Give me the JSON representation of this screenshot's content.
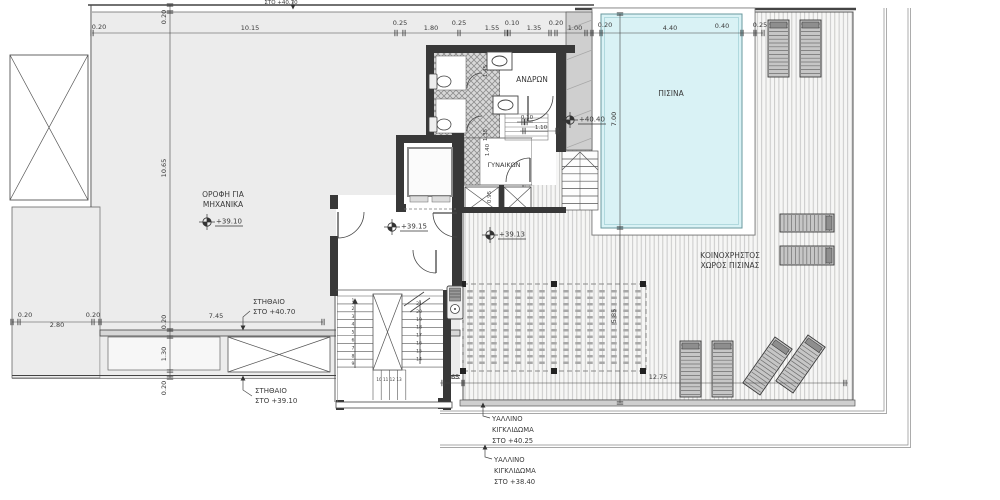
{
  "title": "Roof / pool deck floor plan (+39.10 – +40.40)",
  "colors": {
    "slab": "#ececec",
    "wall_dark": "#383838",
    "wall_band": "#cfcfcf",
    "deck_bg": "#f6f6f5",
    "deck_stripe": "#c4c4c4",
    "pool_fill": "#d9f2f5",
    "pool_edge": "#69989e",
    "text": "#3a3a3a"
  },
  "rooms": [
    {
      "name": "ΟΡΟΦΗ ΓΙΑ ΜΗΧΑΝΙΚΑ",
      "level": "+39.10"
    },
    {
      "name": "ΑΝΔΡΩΝ"
    },
    {
      "name": "ΓΥΝΑΙΚΩΝ"
    },
    {
      "name": "ΠΙΣΙΝΑ",
      "level": "+40.40"
    },
    {
      "name": "ΚΟΙΝΟΧΡΗΣΤΟΣ ΧΩΡΟΣ ΠΙΣΙΝΑΣ",
      "level": "+39.13"
    }
  ],
  "levels": [
    {
      "x": 207,
      "y": 222,
      "label": "+39.10"
    },
    {
      "x": 392,
      "y": 227,
      "label": "+39.15"
    },
    {
      "x": 490,
      "y": 235,
      "label": "+39.13"
    },
    {
      "x": 570,
      "y": 120,
      "label": "+40.40"
    }
  ],
  "stair": {
    "left": [
      "1",
      "2",
      "3",
      "4",
      "5",
      "6",
      "7",
      "8",
      "9"
    ],
    "right": [
      "21",
      "20",
      "19",
      "18",
      "17",
      "16",
      "15",
      "14"
    ],
    "bottom": "10 11 12 13"
  },
  "labels": [
    {
      "t": "0.20",
      "x": 99,
      "y": 29,
      "s": 6.5
    },
    {
      "t": "10.15",
      "x": 250,
      "y": 30,
      "s": 6.5
    },
    {
      "t": "0.25",
      "x": 400,
      "y": 25,
      "s": 6.5
    },
    {
      "t": "1.80",
      "x": 431,
      "y": 30,
      "s": 6.5
    },
    {
      "t": "0.25",
      "x": 459,
      "y": 25,
      "s": 6.5
    },
    {
      "t": "1.55",
      "x": 492,
      "y": 30,
      "s": 6.5
    },
    {
      "t": "0.10",
      "x": 512,
      "y": 25,
      "s": 6.5
    },
    {
      "t": "1.35",
      "x": 534,
      "y": 30,
      "s": 6.5
    },
    {
      "t": "0.20",
      "x": 556,
      "y": 25,
      "s": 6.5
    },
    {
      "t": "1.00",
      "x": 575,
      "y": 30,
      "s": 6.5
    },
    {
      "t": "0.20",
      "x": 605,
      "y": 27,
      "s": 6.5
    },
    {
      "t": "4.40",
      "x": 670,
      "y": 30,
      "s": 6.5
    },
    {
      "t": "0.40",
      "x": 722,
      "y": 28,
      "s": 6.5
    },
    {
      "t": "0.25",
      "x": 760,
      "y": 27,
      "s": 6.5
    },
    {
      "t": "0.20",
      "x": 166,
      "y": 17,
      "s": 6.5,
      "r": -90
    },
    {
      "t": "10.65",
      "x": 166,
      "y": 168,
      "s": 6.5,
      "r": -90
    },
    {
      "t": "0.20",
      "x": 166,
      "y": 322,
      "s": 6.5,
      "r": -90
    },
    {
      "t": "1.30",
      "x": 166,
      "y": 354,
      "s": 6.5,
      "r": -90
    },
    {
      "t": "0.20",
      "x": 166,
      "y": 388,
      "s": 6.5,
      "r": -90
    },
    {
      "t": "0.20",
      "x": 25,
      "y": 317,
      "s": 6.5
    },
    {
      "t": "2.80",
      "x": 57,
      "y": 327,
      "s": 6.5
    },
    {
      "t": "0.20",
      "x": 93,
      "y": 317,
      "s": 6.5
    },
    {
      "t": "7.45",
      "x": 216,
      "y": 318,
      "s": 6.5
    },
    {
      "t": "ΣΤΗΘΑΙΟ",
      "x": 253,
      "y": 304,
      "s": 7,
      "a": "s"
    },
    {
      "t": "ΣΤΟ +40.70",
      "x": 253,
      "y": 314,
      "s": 7,
      "a": "s"
    },
    {
      "t": "ΣΤΗΘΑΙΟ",
      "x": 255,
      "y": 393,
      "s": 7,
      "a": "s"
    },
    {
      "t": "ΣΤΟ +39.10",
      "x": 255,
      "y": 403,
      "s": 7,
      "a": "s"
    },
    {
      "t": "ΟΡΟΦΗ ΓΙΑ",
      "x": 223,
      "y": 197,
      "s": 7.5
    },
    {
      "t": "ΜΗΧΑΝΙΚΑ",
      "x": 223,
      "y": 207,
      "s": 7.5
    },
    {
      "t": "ΑΝΔΡΩΝ",
      "x": 532,
      "y": 82,
      "s": 7.5
    },
    {
      "t": "ΓΥΝΑΙΚΩΝ",
      "x": 504,
      "y": 167,
      "s": 6.5
    },
    {
      "t": "ΠΙΣΙΝΑ",
      "x": 671,
      "y": 96,
      "s": 7.5
    },
    {
      "t": "ΚΟΙΝΟΧΡΗΣΤΟΣ",
      "x": 730,
      "y": 258,
      "s": 7.5
    },
    {
      "t": "ΧΩΡΟΣ ΠΙΣΙΝΑΣ",
      "x": 730,
      "y": 268,
      "s": 7.5
    },
    {
      "t": "0.10",
      "x": 527,
      "y": 119,
      "s": 5.5
    },
    {
      "t": "1.10",
      "x": 541,
      "y": 129,
      "s": 5.5
    },
    {
      "t": "1.45",
      "x": 487,
      "y": 71,
      "s": 5.5,
      "r": -90
    },
    {
      "t": "1.35",
      "x": 487,
      "y": 135,
      "s": 5.5,
      "r": -90
    },
    {
      "t": "1.40",
      "x": 489,
      "y": 150,
      "s": 5.5,
      "r": -90
    },
    {
      "t": "0.95",
      "x": 491,
      "y": 197,
      "s": 5.5,
      "r": -90
    },
    {
      "t": "7.00",
      "x": 616,
      "y": 119,
      "s": 6.5,
      "r": -90
    },
    {
      "t": "5.85",
      "x": 616,
      "y": 316,
      "s": 6.5,
      "r": -90
    },
    {
      "t": "12.75",
      "x": 658,
      "y": 379,
      "s": 6.5
    },
    {
      "t": "0.65",
      "x": 452,
      "y": 379,
      "s": 6.5
    },
    {
      "t": "ΥΑΛΛΙΝΟ",
      "x": 492,
      "y": 421,
      "s": 6.8,
      "a": "s"
    },
    {
      "t": "ΚΙΓΚΛΙΔΩΜΑ",
      "x": 492,
      "y": 432,
      "s": 6.8,
      "a": "s"
    },
    {
      "t": "ΣΤΟ +40.25",
      "x": 492,
      "y": 443,
      "s": 6.8,
      "a": "s"
    },
    {
      "t": "ΥΑΛΛΙΝΟ",
      "x": 494,
      "y": 462,
      "s": 6.8,
      "a": "s"
    },
    {
      "t": "ΚΙΓΚΛΙΔΩΜΑ",
      "x": 494,
      "y": 473,
      "s": 6.8,
      "a": "s"
    },
    {
      "t": "ΣΤΟ +38.40",
      "x": 494,
      "y": 484,
      "s": 6.8,
      "a": "s"
    },
    {
      "t": "ΣΤΟ +40.70",
      "x": 281,
      "y": 4,
      "s": 5.5
    },
    {
      "t": "10 11 12 13",
      "x": 389,
      "y": 381,
      "s": 4.2
    }
  ]
}
